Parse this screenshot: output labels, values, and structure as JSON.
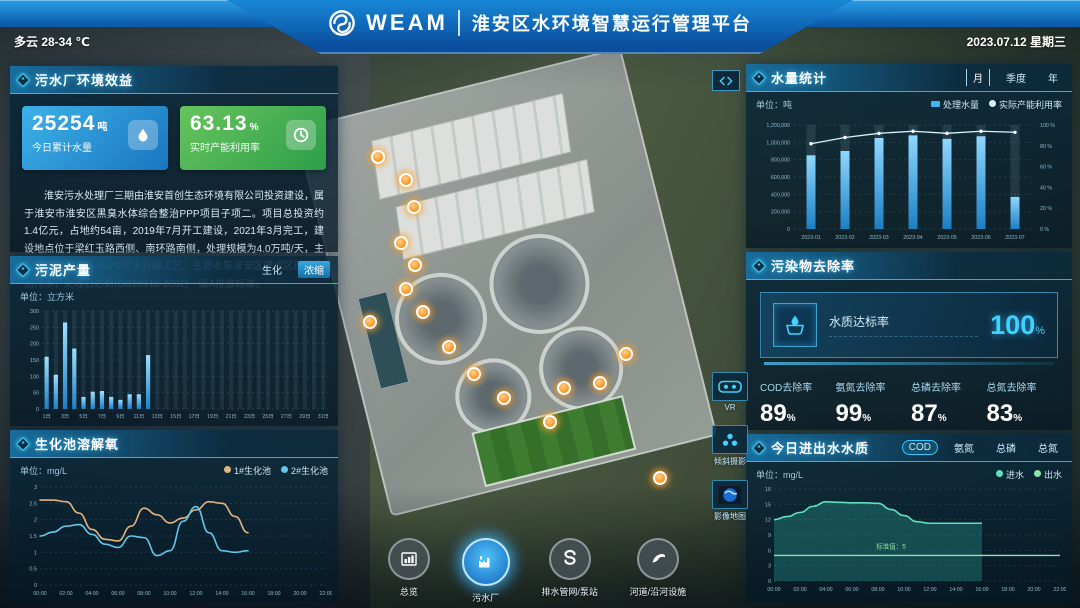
{
  "header": {
    "weather": "多云 28-34 ℃",
    "brand": "WEAM",
    "title": "淮安区水环境智慧运行管理平台",
    "date": "2023.07.12 星期三"
  },
  "left_column": {
    "benefit_panel": {
      "title": "污水厂环境效益",
      "cards": [
        {
          "value": "25254",
          "unit": "吨",
          "label": "今日累计水量",
          "icon": "water-drop-icon",
          "color": "#2b9fd9"
        },
        {
          "value": "63.13",
          "unit": "%",
          "label": "实时产能利用率",
          "icon": "gauge-icon",
          "color": "#4db84f"
        }
      ],
      "description": "淮安污水处理厂三期由淮安首创生态环境有限公司投资建设，属于淮安市淮安区黑臭水体综合整治PPP项目子项二。项目总投资约1.4亿元，占地约54亩，2019年7月开工建设，2021年3月完工，建设地点位于梁红玉路西侧、南环路南侧，处理规模为4.0万吨/天，主体工艺采用改良A/A/O污水处理工艺。主要收集淮安区建成区居民生活污水，处理后达到(GB18918-2002)一级A排放标准。"
    },
    "sludge_panel": {
      "title": "污泥产量",
      "tabs": [
        {
          "label": "生化",
          "active": false
        },
        {
          "label": "浓缩",
          "active": true
        }
      ]
    },
    "oxygen_panel": {
      "title": "生化池溶解氧"
    }
  },
  "right_column": {
    "volume_panel": {
      "title": "水量统计",
      "tabs": [
        {
          "label": "月",
          "active": true
        },
        {
          "label": "季度",
          "active": false
        },
        {
          "label": "年",
          "active": false
        }
      ]
    },
    "removal_panel": {
      "title": "污染物去除率",
      "compliance": {
        "label": "水质达标率",
        "value": "100",
        "unit": "%"
      },
      "stats": [
        {
          "label": "COD去除率",
          "value": "89",
          "unit": "%"
        },
        {
          "label": "氨氮去除率",
          "value": "99",
          "unit": "%"
        },
        {
          "label": "总磷去除率",
          "value": "87",
          "unit": "%"
        },
        {
          "label": "总氮去除率",
          "value": "83",
          "unit": "%"
        }
      ]
    },
    "quality_panel": {
      "title": "今日进出水水质",
      "tabs": [
        {
          "label": "COD",
          "active": true
        },
        {
          "label": "氨氮",
          "active": false
        },
        {
          "label": "总磷",
          "active": false
        },
        {
          "label": "总氮",
          "active": false
        }
      ]
    }
  },
  "map": {
    "tool_buttons": [
      {
        "label": "VR",
        "icon": "vr-goggles-icon"
      },
      {
        "label": "倾斜摄影",
        "icon": "oblique-photo-icon"
      },
      {
        "label": "影像地图",
        "icon": "imagery-map-icon"
      }
    ],
    "markers": [
      [
        376,
        155
      ],
      [
        404,
        178
      ],
      [
        412,
        205
      ],
      [
        399,
        241
      ],
      [
        413,
        263
      ],
      [
        404,
        287
      ],
      [
        421,
        310
      ],
      [
        447,
        345
      ],
      [
        472,
        372
      ],
      [
        502,
        396
      ],
      [
        548,
        420
      ],
      [
        562,
        386
      ],
      [
        598,
        381
      ],
      [
        624,
        352
      ],
      [
        368,
        320
      ],
      [
        658,
        476
      ]
    ]
  },
  "bottom_nav": [
    {
      "label": "总览",
      "icon": "overview-icon",
      "active": false
    },
    {
      "label": "污水厂",
      "icon": "sewage-plant-icon",
      "active": true
    },
    {
      "label": "排水管网/泵站",
      "icon": "pipe-network-icon",
      "active": false
    },
    {
      "label": "河道/沿河设施",
      "icon": "river-facility-icon",
      "active": false
    }
  ],
  "chart_data": [
    {
      "id": "sludge",
      "type": "bar",
      "title": "污泥产量",
      "unit_label": "单位：立方米",
      "categories": [
        "1日",
        "2日",
        "3日",
        "4日",
        "5日",
        "6日",
        "7日",
        "8日",
        "9日",
        "10日",
        "11日",
        "12日",
        "13日",
        "14日",
        "15日",
        "16日",
        "17日",
        "18日",
        "19日",
        "20日",
        "21日",
        "22日",
        "23日",
        "24日",
        "25日",
        "26日",
        "27日",
        "28日",
        "29日",
        "30日",
        "31日"
      ],
      "values": [
        160,
        105,
        265,
        185,
        37,
        53,
        55,
        37,
        28,
        45,
        45,
        165,
        null,
        null,
        null,
        null,
        null,
        null,
        null,
        null,
        null,
        null,
        null,
        null,
        null,
        null,
        null,
        null,
        null,
        null,
        null
      ],
      "ylim": [
        0,
        300
      ],
      "ytick": 50,
      "bar_color": "#4fc3f7"
    },
    {
      "id": "oxygen",
      "type": "line",
      "title": "生化池溶解氧",
      "unit_label": "单位：mg/L",
      "x_ticks": [
        "00:00",
        "02:00",
        "04:00",
        "06:00",
        "08:00",
        "10:00",
        "12:00",
        "14:00",
        "16:00",
        "18:00",
        "20:00",
        "22:00"
      ],
      "x_hours_span": 22,
      "series": [
        {
          "name": "1#生化池",
          "color": "#e3b47e",
          "values": [
            2.6,
            2.6,
            2.55,
            2.2,
            1.7,
            1.4,
            1.35,
            1.8,
            2.35,
            2.15,
            1.9,
            2.05,
            2.3,
            2.55,
            2.5,
            2.1,
            1.6
          ]
        },
        {
          "name": "2#生化池",
          "color": "#63c8e8",
          "values": [
            1.5,
            1.62,
            1.8,
            1.85,
            1.55,
            1.25,
            1.15,
            1.5,
            1.45,
            0.9,
            1.05,
            1.95,
            2.4,
            1.6,
            1.05,
            1.0,
            1.05
          ]
        }
      ],
      "ylim": [
        0,
        3
      ],
      "ytick": 0.5
    },
    {
      "id": "volume",
      "type": "bar+line",
      "title": "水量统计",
      "unit_label": "单位：吨",
      "categories": [
        "2023-01",
        "2023-02",
        "2023-03",
        "2023-04",
        "2023-05",
        "2023-06",
        "2023-07"
      ],
      "series": [
        {
          "name": "处理水量",
          "type": "bar",
          "color": "#3fb6f0",
          "values": [
            850000,
            900000,
            1050000,
            1080000,
            1040000,
            1070000,
            370000
          ]
        },
        {
          "name": "实际产能利用率",
          "type": "line",
          "color": "#d8f2fc",
          "values": [
            82,
            88,
            92,
            94,
            92,
            94,
            93
          ]
        }
      ],
      "ylim_left": [
        0,
        1200000
      ],
      "ytick_left": 200000,
      "ylim_right": [
        0,
        100
      ],
      "ytick_right": 20
    },
    {
      "id": "quality",
      "type": "area",
      "title": "今日进出水水质",
      "unit_label": "单位：mg/L",
      "x_ticks": [
        "00:00",
        "02:00",
        "04:00",
        "06:00",
        "08:00",
        "10:00",
        "12:00",
        "14:00",
        "16:00",
        "18:00",
        "20:00",
        "22:00"
      ],
      "x_hours_span": 22,
      "series": [
        {
          "name": "进水",
          "color": "#5fe0c0",
          "values": [
            12,
            12.6,
            13.4,
            14.6,
            15.5,
            15.4,
            15.3,
            15.3,
            15.2,
            14.0,
            12.8,
            11.6,
            11.3,
            11.3,
            11.3,
            11.3,
            11.3
          ]
        },
        {
          "name": "出水",
          "color": "#8fe3a8",
          "constant": 5
        }
      ],
      "annotation": "标准值：5",
      "ylim": [
        0,
        18
      ],
      "ytick": 3
    }
  ]
}
